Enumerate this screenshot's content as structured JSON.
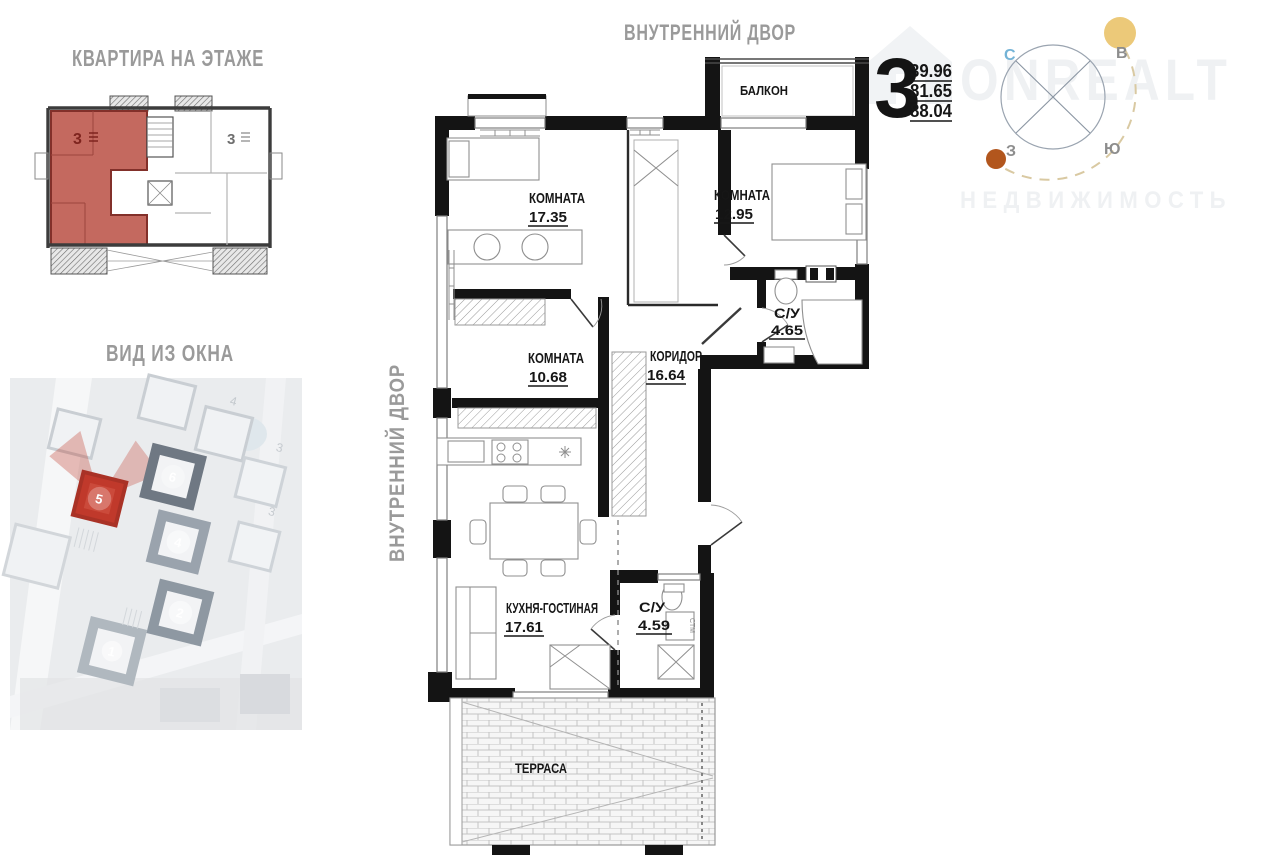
{
  "titles": {
    "floor_overview": "КВАРТИРА НА ЭТАЖЕ",
    "window_view": "ВИД ИЗ ОКНА",
    "courtyard_top": "ВНУТРЕННИЙ ДВОР",
    "courtyard_left": "ВНУТРЕННИЙ ДВОР"
  },
  "apartment_info": {
    "rooms_count": "3",
    "living_area": "39.96",
    "apartment_area": "81.65",
    "total_area": "88.04"
  },
  "compass": {
    "north": "С",
    "east": "В",
    "west": "З",
    "south": "Ю"
  },
  "watermark": {
    "brand": "ONREALT",
    "subtitle": "НЕДВИЖИМОСТЬ"
  },
  "floor_plan": {
    "balcony": {
      "name": "БАЛКОН"
    },
    "room1": {
      "name": "КОМНАТА",
      "area": "17.35"
    },
    "room2": {
      "name": "КОМНАТА",
      "area": "12.95"
    },
    "bathroom1": {
      "name": "С/У",
      "area": "4.65"
    },
    "room3": {
      "name": "КОМНАТА",
      "area": "10.68"
    },
    "corridor": {
      "name": "КОРИДОР",
      "area": "16.64"
    },
    "kitchen": {
      "name": "КУХНЯ-ГОСТИНАЯ",
      "area": "17.61"
    },
    "bathroom2": {
      "name": "С/У",
      "area": "4.59"
    },
    "terrace": {
      "name": "ТЕРРАСА"
    },
    "washer_label": "СТМ"
  },
  "floor_overview": {
    "apartment_number": "3",
    "neighbor_number": "3",
    "highlight_color": "#c4695f"
  },
  "window_view_map": {
    "highlighted_building": "5",
    "building_numbers": [
      "6",
      "4",
      "2",
      "1"
    ],
    "faint_labels": [
      "4",
      "3",
      "3"
    ],
    "highlight_color": "#c23b2d"
  }
}
